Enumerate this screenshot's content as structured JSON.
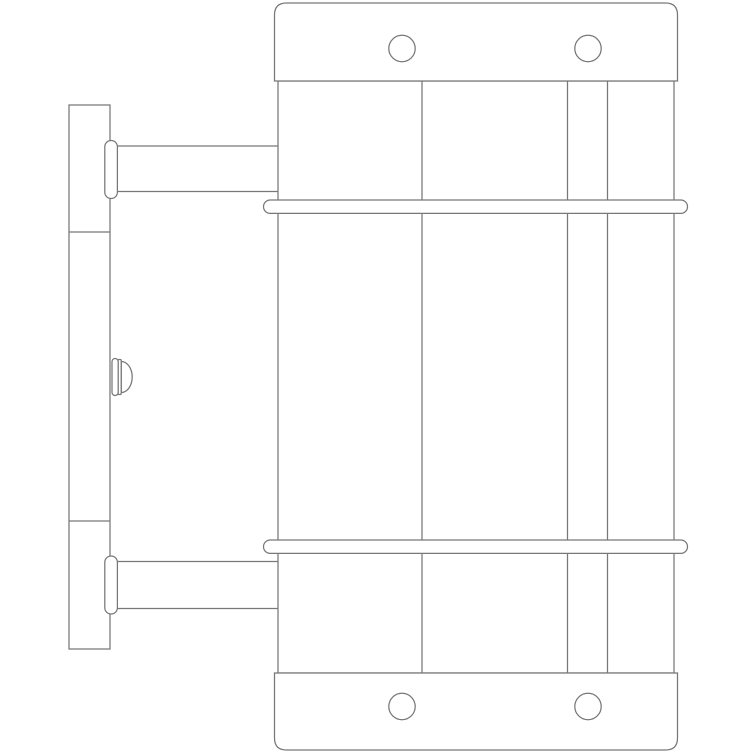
{
  "drawing": {
    "width": 755,
    "height": 755,
    "background": "#ffffff",
    "stroke_color": "#787878",
    "stroke_width": 1.25,
    "shapes": [
      {
        "name": "wall-plate",
        "type": "rect",
        "x": 69,
        "y": 105,
        "w": 41,
        "h": 544,
        "fill": "#ffffff"
      },
      {
        "name": "wall-plate-seam-upper",
        "type": "line",
        "x1": 69,
        "y1": 232,
        "x2": 110,
        "y2": 232
      },
      {
        "name": "wall-plate-seam-lower",
        "type": "line",
        "x1": 69,
        "y1": 521,
        "x2": 110,
        "y2": 521
      },
      {
        "name": "adjustment-screw-dome",
        "type": "path",
        "d": "M 121.2 361.5 A 11 15.5 0 0 1 121.2 392.5 Z",
        "fill": "#ffffff"
      },
      {
        "name": "adjustment-screw-washer",
        "type": "rect",
        "x": 118,
        "y": 359.5,
        "w": 3.2,
        "h": 35,
        "rx": 1,
        "fill": "#ffffff"
      },
      {
        "name": "adjustment-screw-shaft",
        "type": "rect",
        "x": 112,
        "y": 358.5,
        "w": 6.2,
        "h": 37,
        "rx": 3.1,
        "fill": "#ffffff"
      },
      {
        "name": "upper-arm-top-line",
        "type": "line",
        "x1": 117,
        "y1": 146,
        "x2": 278,
        "y2": 146
      },
      {
        "name": "upper-arm-bottom-line",
        "type": "line",
        "x1": 117,
        "y1": 191.5,
        "x2": 278,
        "y2": 191.5
      },
      {
        "name": "lower-arm-top-line",
        "type": "line",
        "x1": 117,
        "y1": 561.5,
        "x2": 278,
        "y2": 561.5
      },
      {
        "name": "lower-arm-bottom-line",
        "type": "line",
        "x1": 117,
        "y1": 608.5,
        "x2": 278,
        "y2": 608.5
      },
      {
        "name": "upper-arm-collar",
        "type": "rect",
        "x": 104.8,
        "y": 140.5,
        "w": 12.6,
        "h": 58,
        "rx": 6.3,
        "fill": "#ffffff"
      },
      {
        "name": "lower-arm-collar",
        "type": "rect",
        "x": 104.8,
        "y": 556,
        "w": 12.6,
        "h": 58,
        "rx": 6.3,
        "fill": "#ffffff"
      },
      {
        "name": "cylinder-body",
        "type": "rect",
        "x": 278,
        "y": 81,
        "w": 396,
        "h": 592,
        "fill": "#ffffff"
      },
      {
        "name": "body-contour-line-1",
        "type": "line",
        "x1": 422,
        "y1": 81,
        "x2": 422,
        "y2": 673
      },
      {
        "name": "body-contour-line-2",
        "type": "line",
        "x1": 567.5,
        "y1": 81,
        "x2": 567.5,
        "y2": 673
      },
      {
        "name": "body-contour-line-3",
        "type": "line",
        "x1": 607.5,
        "y1": 81,
        "x2": 607.5,
        "y2": 673
      },
      {
        "name": "top-cap",
        "type": "path",
        "d": "M 274.5 81 L 274.5 15 Q 274.5 3 286.5 3 L 665.5 3 Q 677.5 3 677.5 15 L 677.5 81 Z",
        "fill": "#ffffff"
      },
      {
        "name": "top-cap-hole-left",
        "type": "circle",
        "cx": 402,
        "cy": 48.5,
        "r": 13.2,
        "fill": "#ffffff"
      },
      {
        "name": "top-cap-hole-right",
        "type": "circle",
        "cx": 588,
        "cy": 48.5,
        "r": 13.2,
        "fill": "#ffffff"
      },
      {
        "name": "bottom-cap",
        "type": "path",
        "d": "M 274.5 673 L 677.5 673 L 677.5 738 Q 677.5 750 665.5 750 L 286.5 750 Q 274.5 750 274.5 738 Z",
        "fill": "#ffffff"
      },
      {
        "name": "bottom-cap-hole-left",
        "type": "circle",
        "cx": 402,
        "cy": 706.5,
        "r": 13.2,
        "fill": "#ffffff"
      },
      {
        "name": "bottom-cap-hole-right",
        "type": "circle",
        "cx": 588,
        "cy": 706.5,
        "r": 13.2,
        "fill": "#ffffff"
      },
      {
        "name": "upper-retaining-band",
        "type": "rect",
        "x": 263.5,
        "y": 200,
        "w": 424,
        "h": 13.4,
        "rx": 6.7,
        "fill": "#ffffff"
      },
      {
        "name": "lower-retaining-band",
        "type": "rect",
        "x": 263.5,
        "y": 540,
        "w": 424,
        "h": 13.4,
        "rx": 6.7,
        "fill": "#ffffff"
      }
    ]
  }
}
